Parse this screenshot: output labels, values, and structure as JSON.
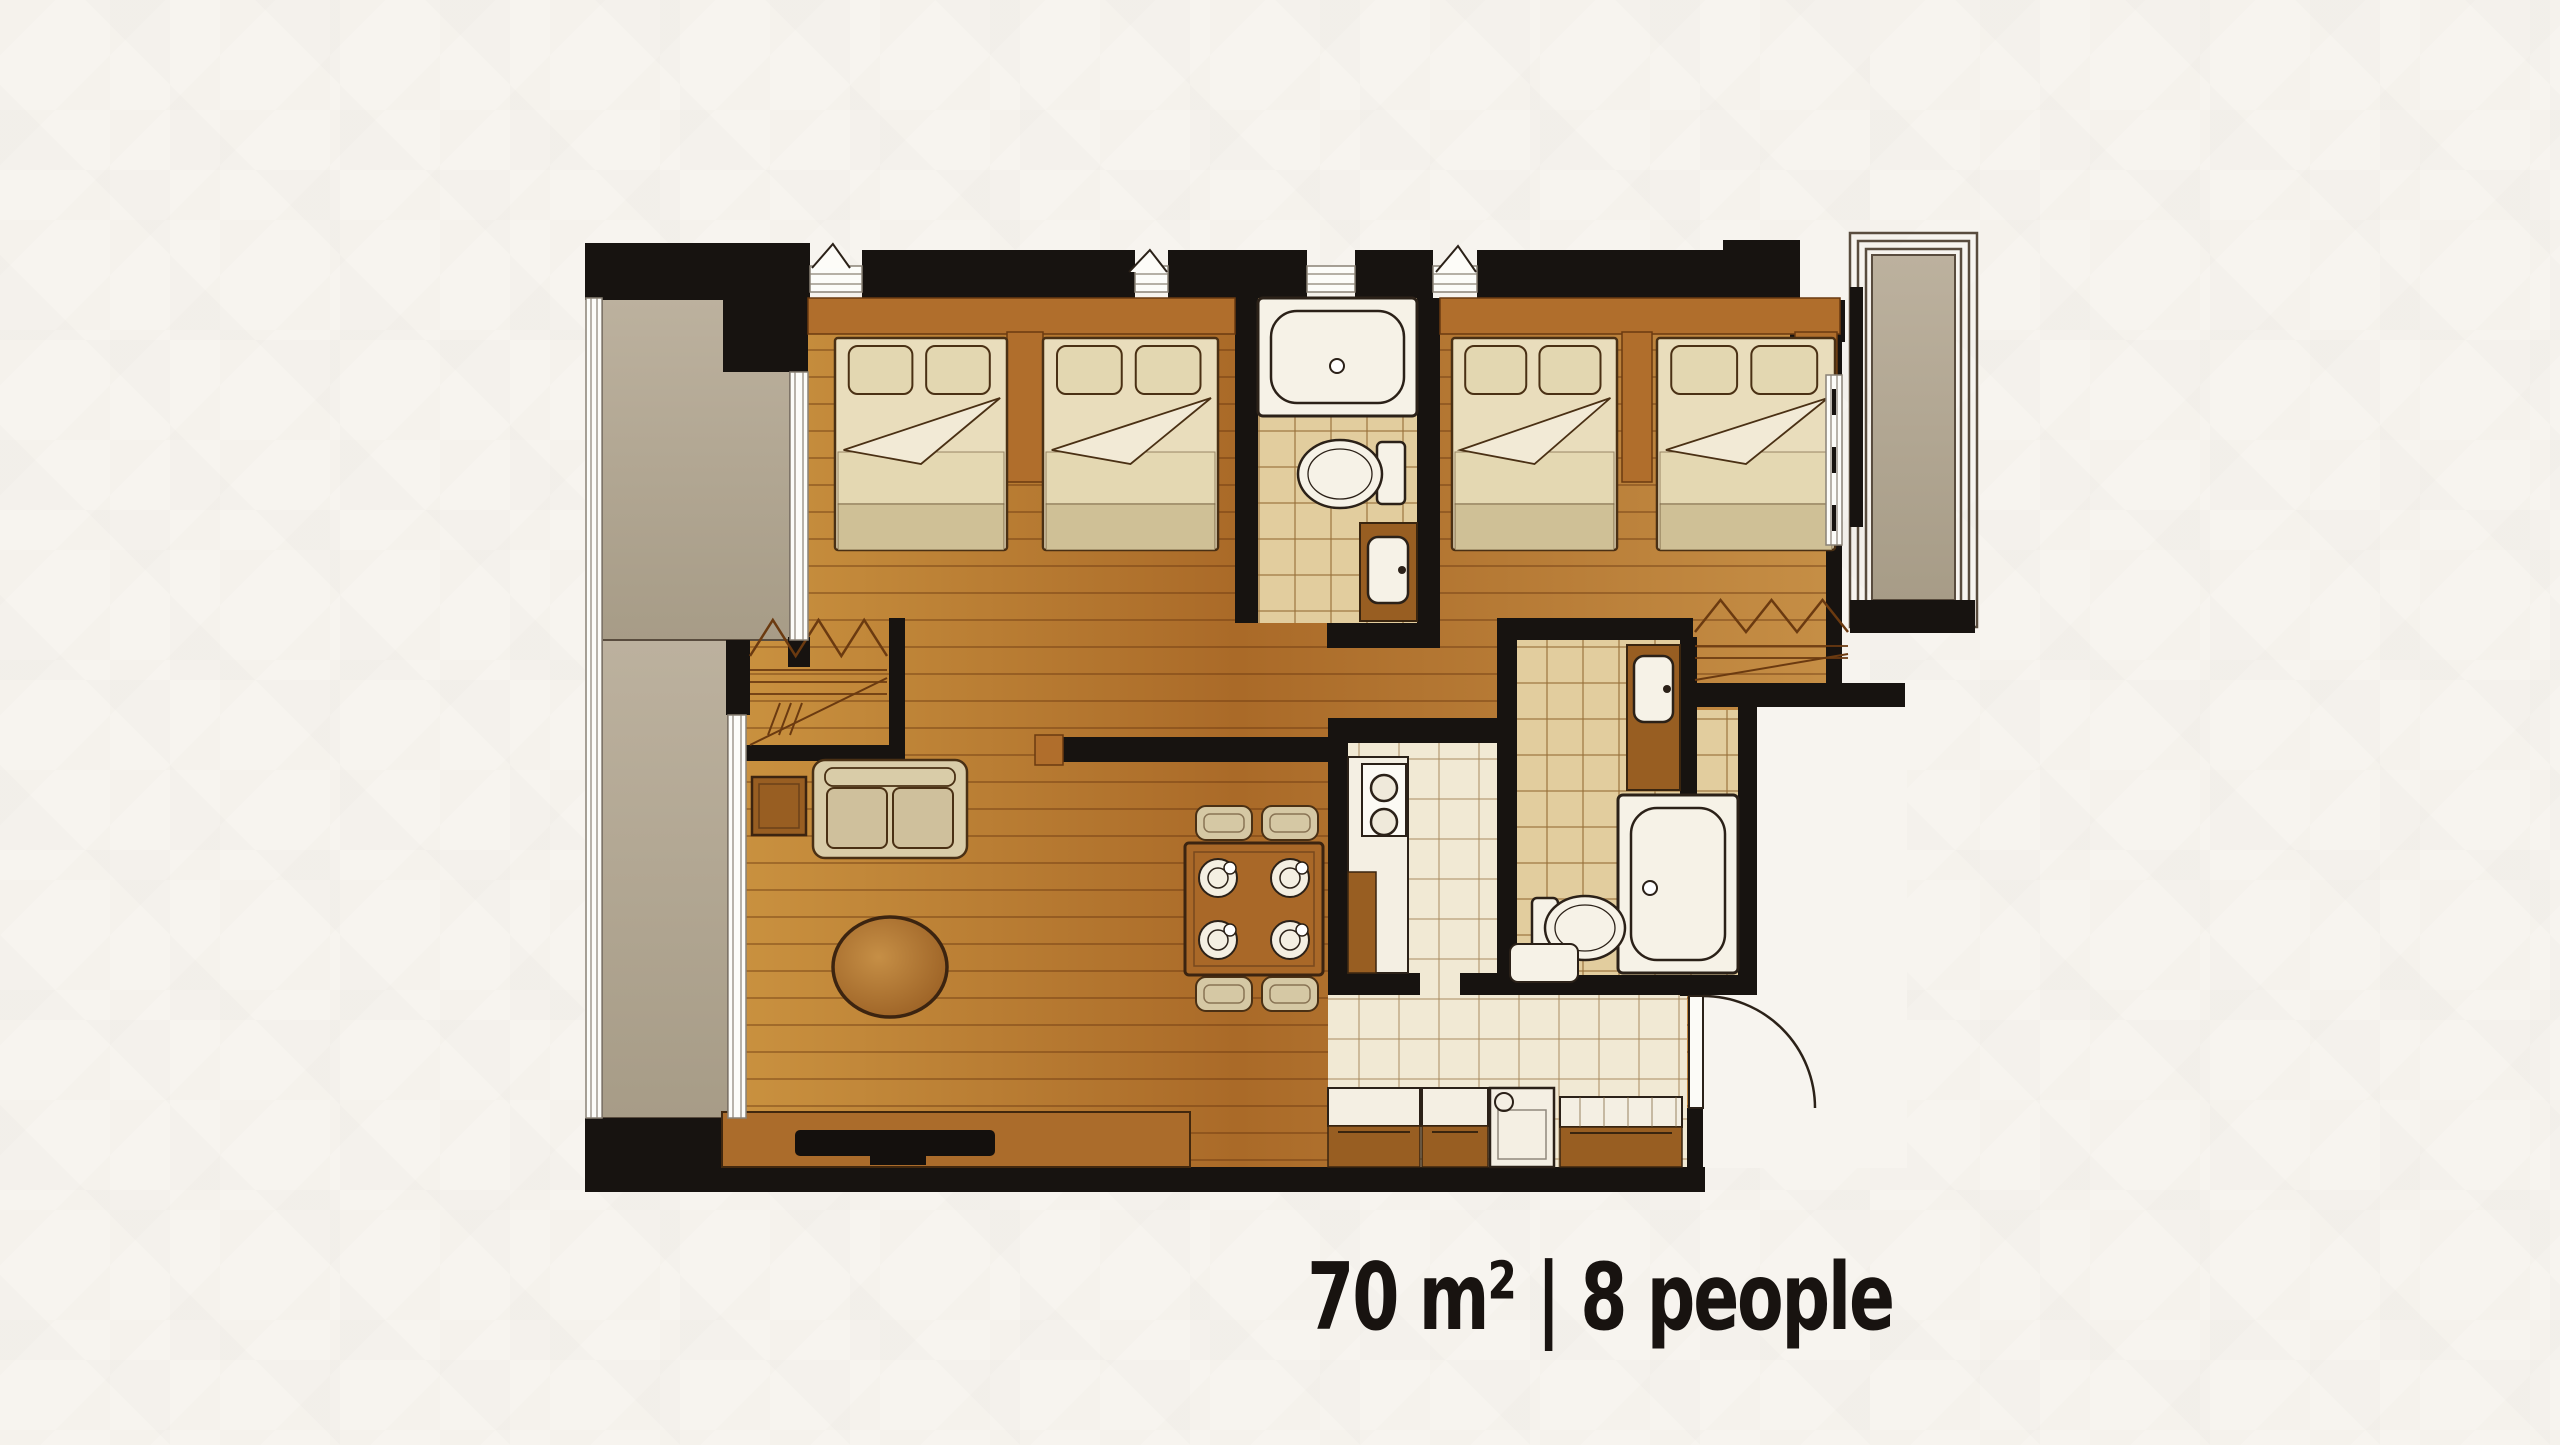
{
  "caption": {
    "text": "70 m² | 8 people",
    "area_label": "70 m²",
    "separator": "|",
    "capacity_label": "8 people"
  },
  "colors": {
    "background": "#f7f4ef",
    "wall": "#171310",
    "wood_grad": [
      "#c9913f",
      "#aa6a28",
      "#c68f46"
    ],
    "wood_mid": "#b06e2c",
    "wood_dark": "#985e22",
    "wood_line": "#6b3a10",
    "concrete": "#b3a893",
    "concrete_edge": "#594c3e",
    "tile_beige": "#e2cd9e",
    "grout_beige": "#b3935f",
    "tile_cream": "#f1e9d4",
    "grout_cream": "#cfbd99",
    "fixture_white": "#f6f2e7",
    "outline": "#2b2118",
    "furniture_line": "#4a3014",
    "bed_cream": "#e9ddbc",
    "pillow": "#e3d7b1",
    "fold_white": "#f2ead6",
    "blanket_light": "#e4d8b2",
    "blanket_dark": "#cfc096",
    "sofa": "#d9cca8",
    "chair": "#d5c8a4",
    "counter_white": "#f4efe3",
    "window_line": "#8a8276",
    "caption_text": "#181310"
  },
  "plan": {
    "rooms": [
      "balcony-left",
      "bedroom-1",
      "bathroom-1",
      "bedroom-2",
      "balcony-right",
      "wardrobe-1",
      "wardrobe-2",
      "living-room",
      "dining-area",
      "kitchen",
      "bathroom-2",
      "entry-hall"
    ],
    "wood": [
      [
        744,
        298,
        1096,
        870
      ]
    ],
    "exterior": [
      [
        1757,
        707,
        150,
        288
      ],
      [
        1703,
        995,
        204,
        173
      ]
    ],
    "tiles_beige": [
      [
        1258,
        298,
        159,
        325
      ],
      [
        1517,
        640,
        163,
        72
      ],
      [
        1517,
        710,
        221,
        265
      ]
    ],
    "tiles_cream": [
      [
        1348,
        743,
        149,
        230
      ],
      [
        1328,
        995,
        359,
        172
      ],
      [
        1420,
        973,
        40,
        22
      ]
    ],
    "concrete": [
      [
        602,
        298,
        188,
        342
      ],
      [
        602,
        640,
        126,
        478
      ],
      [
        1872,
        255,
        83,
        345
      ]
    ],
    "balcony_frames": [
      [
        1850,
        233,
        127,
        394
      ],
      [
        1858,
        241,
        111,
        378
      ],
      [
        1866,
        249,
        95,
        362
      ]
    ],
    "headboards": [
      [
        808,
        298,
        427,
        36
      ],
      [
        1440,
        298,
        400,
        36
      ]
    ],
    "wood_blocks": [
      [
        1007,
        332,
        36,
        150
      ],
      [
        1622,
        332,
        30,
        150
      ],
      [
        1795,
        332,
        42,
        58
      ],
      [
        1035,
        735,
        28,
        30
      ]
    ],
    "beds": [
      [
        835,
        332,
        172,
        218
      ],
      [
        1043,
        332,
        175,
        218
      ],
      [
        1452,
        332,
        165,
        218
      ],
      [
        1657,
        332,
        178,
        218
      ]
    ],
    "wardrobes": [
      [
        750,
        620,
        137,
        125
      ],
      [
        1695,
        600,
        153,
        80
      ]
    ],
    "walls": [
      [
        585,
        243,
        225,
        57
      ],
      [
        723,
        300,
        85,
        72
      ],
      [
        726,
        640,
        24,
        75
      ],
      [
        788,
        637,
        22,
        30
      ],
      [
        585,
        1118,
        159,
        74
      ],
      [
        585,
        1167,
        1120,
        25
      ],
      [
        862,
        250,
        273,
        48
      ],
      [
        1168,
        250,
        139,
        48
      ],
      [
        1355,
        250,
        78,
        48
      ],
      [
        1477,
        250,
        246,
        48
      ],
      [
        1723,
        240,
        77,
        77
      ],
      [
        1790,
        300,
        55,
        42
      ],
      [
        1235,
        298,
        23,
        325
      ],
      [
        1417,
        298,
        23,
        350
      ],
      [
        1327,
        623,
        113,
        25
      ],
      [
        1497,
        618,
        196,
        22
      ],
      [
        1328,
        718,
        189,
        25
      ],
      [
        1328,
        743,
        20,
        252
      ],
      [
        1497,
        640,
        20,
        355
      ],
      [
        1328,
        973,
        92,
        22
      ],
      [
        1460,
        973,
        37,
        22
      ],
      [
        1738,
        707,
        19,
        288
      ],
      [
        1497,
        975,
        241,
        20
      ],
      [
        1680,
        637,
        17,
        158
      ],
      [
        1693,
        683,
        212,
        24
      ],
      [
        1687,
        1108,
        16,
        60
      ],
      [
        1680,
        975,
        23,
        21
      ],
      [
        889,
        618,
        16,
        141
      ],
      [
        744,
        745,
        161,
        16
      ],
      [
        1060,
        737,
        268,
        25
      ],
      [
        1824,
        317,
        18,
        58
      ],
      [
        1826,
        545,
        16,
        138
      ],
      [
        1850,
        287,
        13,
        240
      ],
      [
        1850,
        600,
        125,
        33
      ]
    ],
    "windows": [
      {
        "r": [
          586,
          298,
          16,
          820
        ],
        "o": "v"
      },
      {
        "r": [
          790,
          372,
          18,
          268
        ],
        "o": "v"
      },
      {
        "r": [
          728,
          715,
          18,
          403
        ],
        "o": "v"
      },
      {
        "r": [
          1826,
          375,
          16,
          170
        ],
        "o": "v",
        "dashes": true
      },
      {
        "r": [
          810,
          266,
          52,
          26
        ],
        "o": "h"
      },
      {
        "r": [
          1135,
          266,
          33,
          26
        ],
        "o": "h"
      },
      {
        "r": [
          1307,
          266,
          48,
          26
        ],
        "o": "h"
      },
      {
        "r": [
          1433,
          266,
          44,
          26
        ],
        "o": "h"
      }
    ],
    "window_marks": [
      [
        812,
        244,
        38,
        24
      ],
      [
        1129,
        250,
        38,
        22
      ],
      [
        1436,
        246,
        40,
        26
      ]
    ],
    "fixtures": {
      "tubs": [
        {
          "r": [
            1258,
            298,
            159,
            118
          ],
          "drain": [
            1337,
            366
          ]
        },
        {
          "r": [
            1618,
            795,
            120,
            178
          ],
          "drain": [
            1650,
            888
          ]
        }
      ],
      "toilets": [
        {
          "bowl": [
            1340,
            474,
            42,
            34
          ],
          "tank": [
            1377,
            442,
            28,
            62
          ]
        },
        {
          "bowl": [
            1585,
            928,
            40,
            32
          ],
          "tank": [
            1532,
            898,
            26,
            62
          ]
        }
      ],
      "vanities": [
        {
          "r": [
            1360,
            523,
            57,
            98
          ],
          "sink": [
            1368,
            537,
            40,
            66
          ]
        },
        {
          "r": [
            1627,
            645,
            53,
            145
          ],
          "sink": [
            1634,
            656,
            39,
            66
          ]
        }
      ],
      "washer": [
        1510,
        944,
        68,
        38
      ],
      "kitchen": {
        "counter": [
          1348,
          757,
          60,
          216
        ],
        "stove": [
          1362,
          764,
          44,
          72
        ],
        "burners": [
          [
            1384,
            788,
            13
          ],
          [
            1384,
            822,
            13
          ]
        ],
        "cabinet": [
          1348,
          872,
          28,
          101
        ]
      },
      "counters": [
        {
          "top": [
            1328,
            1088,
            92,
            38
          ],
          "base": [
            1328,
            1126,
            92,
            41
          ]
        },
        {
          "top": [
            1422,
            1088,
            66,
            38
          ],
          "base": [
            1422,
            1126,
            66,
            41
          ]
        },
        {
          "top": [
            1560,
            1097,
            122,
            30
          ],
          "base": [
            1560,
            1127,
            122,
            40
          ],
          "ticks": true
        }
      ],
      "dishwasher": {
        "r": [
          1490,
          1088,
          64,
          79
        ],
        "knob": [
          1504,
          1102,
          9
        ]
      },
      "console": [
        722,
        1112,
        468,
        55
      ],
      "tv": {
        "r": [
          795,
          1130,
          200,
          26
        ],
        "stand": [
          870,
          1156,
          56,
          9
        ]
      },
      "sofa": [
        813,
        760,
        154,
        98
      ],
      "side_table": [
        752,
        777,
        54,
        58
      ],
      "oval": [
        890,
        967,
        57,
        50
      ],
      "dining": {
        "table": [
          1185,
          843,
          138,
          132
        ],
        "chairs": [
          [
            1196,
            806,
            56,
            34
          ],
          [
            1262,
            806,
            56,
            34
          ],
          [
            1196,
            977,
            56,
            34
          ],
          [
            1262,
            977,
            56,
            34
          ]
        ],
        "settings": [
          [
            1218,
            878
          ],
          [
            1290,
            878
          ],
          [
            1218,
            940
          ],
          [
            1290,
            940
          ]
        ]
      },
      "door": {
        "leaf": [
          1689,
          996,
          14,
          112
        ],
        "arc": "M 1703 996 A 112 112 0 0 1 1815 1108"
      }
    }
  }
}
